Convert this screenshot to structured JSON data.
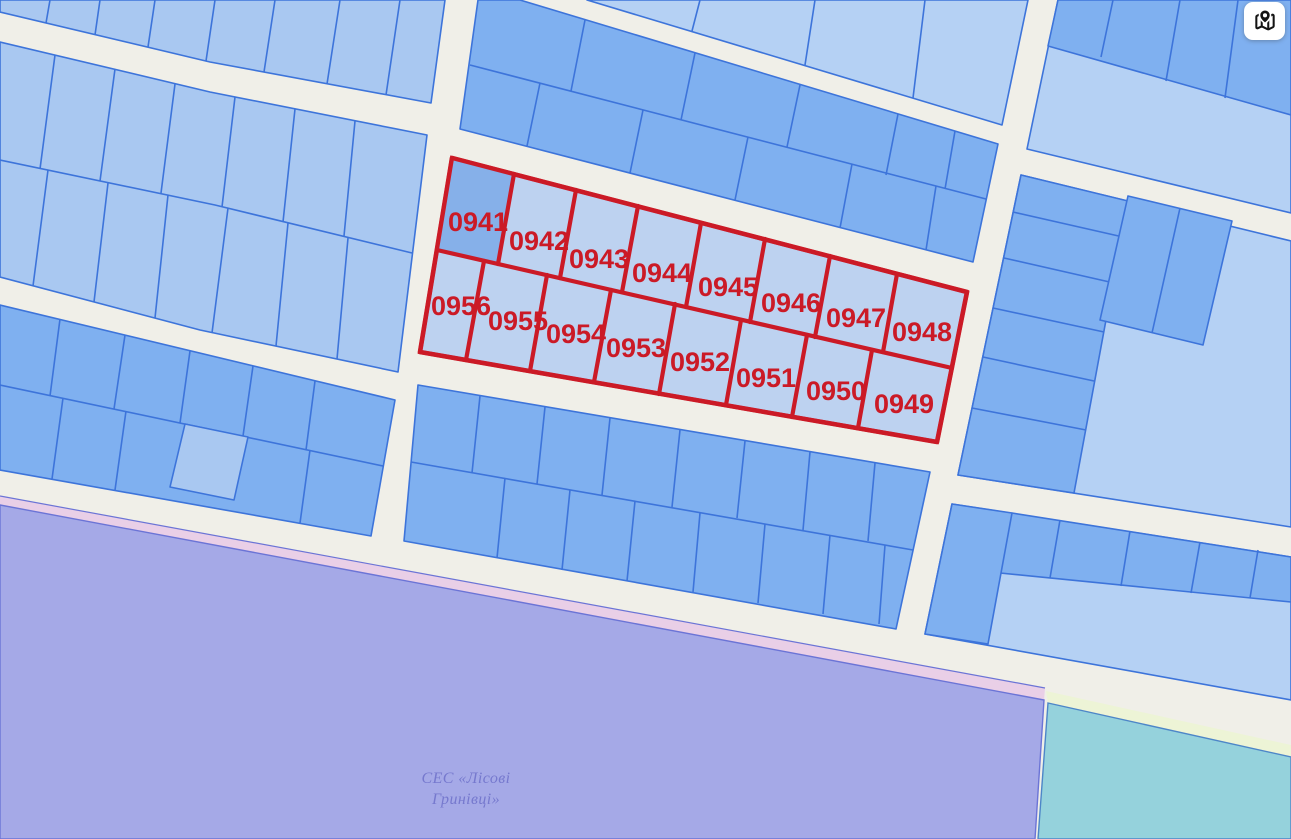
{
  "colors": {
    "road_background": "#f0efe8",
    "parcel_light": "#a9c8f1",
    "parcel_lighter": "#b5d1f4",
    "parcel_medium": "#7fb0f0",
    "parcel_border": "#3d74da",
    "highlight_fill": "#bdd2f0",
    "highlight_fill_dark": "#86b0e9",
    "highlight_red": "#cb1a26",
    "zone_purple": "#a5a9e7",
    "zone_pink": "#e9cfe7",
    "zone_teal": "#95d2dc",
    "zone_yellow": "#edf4d6",
    "area_label_text": "#7679ce"
  },
  "parcels": [
    {
      "number": "0941"
    },
    {
      "number": "0942"
    },
    {
      "number": "0943"
    },
    {
      "number": "0944"
    },
    {
      "number": "0945"
    },
    {
      "number": "0946"
    },
    {
      "number": "0947"
    },
    {
      "number": "0948"
    },
    {
      "number": "0956"
    },
    {
      "number": "0955"
    },
    {
      "number": "0954"
    },
    {
      "number": "0953"
    },
    {
      "number": "0952"
    },
    {
      "number": "0951"
    },
    {
      "number": "0950"
    },
    {
      "number": "0949"
    }
  ],
  "area_label": {
    "line1": "СЕС «Лісові",
    "line2": "Гринівці»"
  },
  "controls": {
    "map_button_icon": "map-pinned-icon"
  }
}
